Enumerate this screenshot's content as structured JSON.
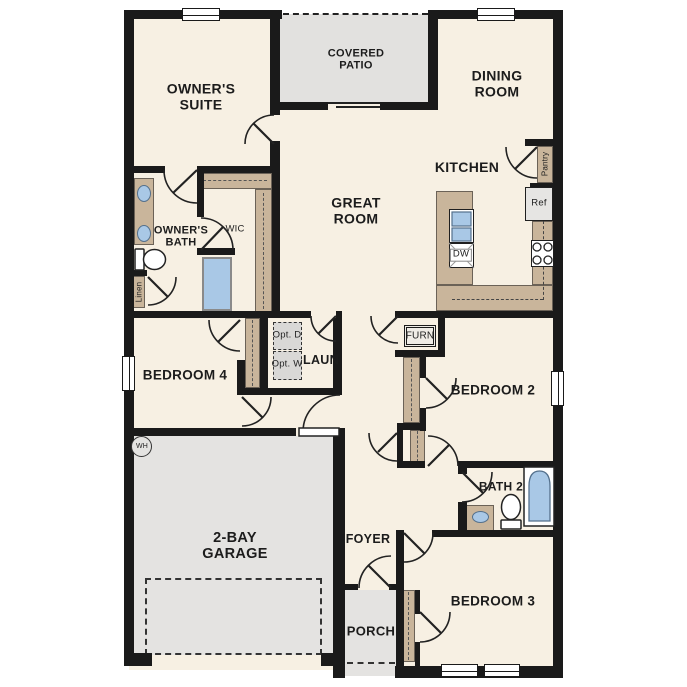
{
  "labels": {
    "owners_suite": "OWNER'S SUITE",
    "covered_patio": "COVERED PATIO",
    "dining_room": "DINING ROOM",
    "kitchen": "KITCHEN",
    "pantry": "Pantry",
    "ref": "Ref",
    "dw": "DW",
    "great_room": "GREAT ROOM",
    "owners_bath": "OWNER'S BATH",
    "wic": "WIC",
    "linen": "Linen",
    "opt_d": "Opt. D",
    "opt_w": "Opt. W",
    "laun": "LAUN",
    "furn": "FURN",
    "bedroom4": "BEDROOM 4",
    "bedroom2": "BEDROOM 2",
    "bedroom3": "BEDROOM 3",
    "bath2": "BATH 2",
    "wh": "WH",
    "garage": "2-BAY GARAGE",
    "foyer": "FOYER",
    "porch": "PORCH"
  },
  "colors": {
    "wall": "#1a1a1a",
    "floor": "#f7f0e3",
    "patio": "#e2e1df",
    "garage": "#e4e3e1",
    "counter": "#c9b59b",
    "fixture": "#a9c8e6",
    "appliance": "#e6e5e3",
    "option_box": "#d9d8d6"
  }
}
